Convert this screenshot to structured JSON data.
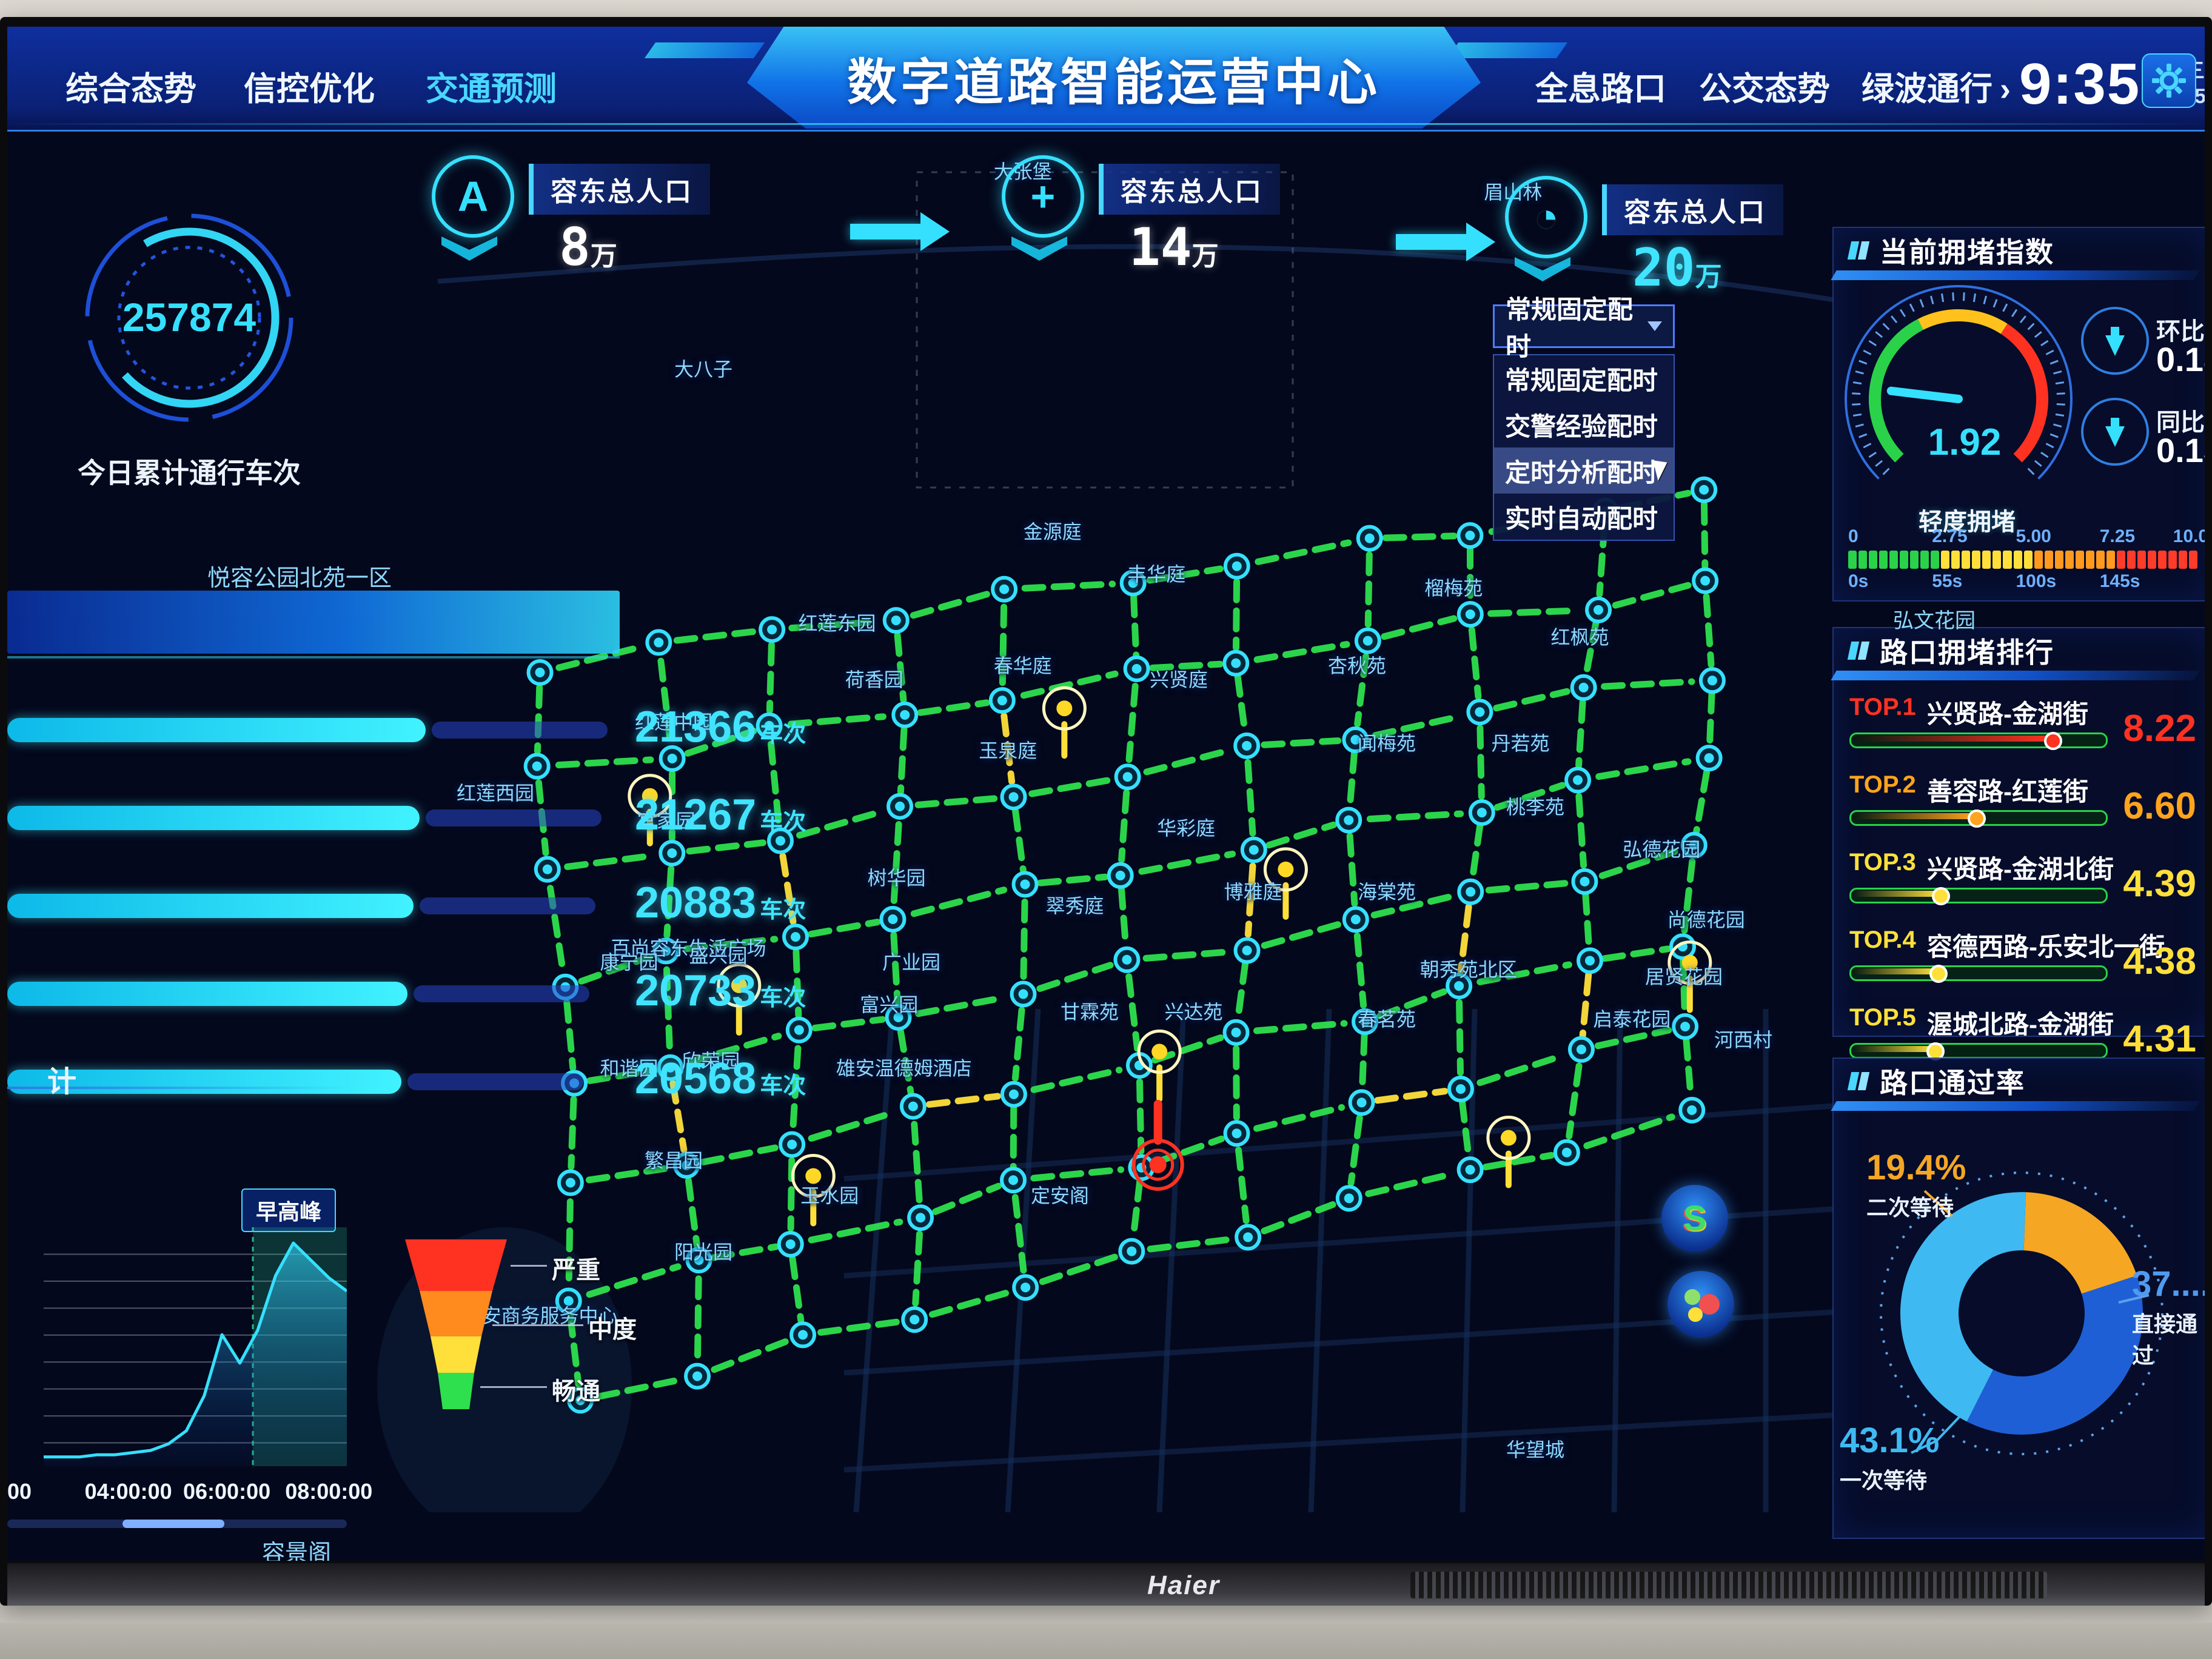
{
  "window": {
    "brand": "Haier"
  },
  "header": {
    "tabs_left": [
      {
        "label": "综合态势",
        "active": false
      },
      {
        "label": "信控优化",
        "active": false
      },
      {
        "label": "交通预测",
        "active": true
      }
    ],
    "title": "数字道路智能运营中心",
    "tabs_right": [
      "全息路口",
      "公交态势",
      "绿波通行"
    ],
    "time": "9:35",
    "weekday": "星期三",
    "date": "2023.5.31"
  },
  "left_panel": {
    "total_gauge": {
      "value": "257874",
      "label": "今日累计通行车次"
    },
    "flow_rank": {
      "region_label": "悦容公园北苑一区",
      "unit": "车次",
      "items": [
        {
          "value": "21366"
        },
        {
          "value": "21267"
        },
        {
          "value": "20883"
        },
        {
          "value": "20733"
        },
        {
          "value": "20568"
        }
      ]
    },
    "flow_trend": {
      "section_title_partial": "计",
      "peak_tag": "早高峰",
      "bottom_label": "容景阁",
      "chart_data": {
        "type": "area",
        "title": "早高峰流量趋势",
        "x_ticks": [
          "00",
          "04:00:00",
          "06:00:00",
          "08:00:00"
        ],
        "x_range": [
          "02:00:00",
          "09:00:00"
        ],
        "values": [
          2,
          2,
          2,
          3,
          3,
          4,
          5,
          8,
          14,
          30,
          58,
          45,
          60,
          85,
          100,
          92,
          84,
          78
        ],
        "highlight_band_pct": [
          69,
          100
        ],
        "grid": true
      }
    }
  },
  "map": {
    "population_badges": [
      {
        "icon": "a-badge-icon",
        "glyph": "A",
        "label": "容东总人口",
        "value": "8",
        "unit": "万",
        "cyan": false
      },
      {
        "icon": "medical-cross-icon",
        "glyph": "+",
        "label": "容东总人口",
        "value": "14",
        "unit": "万",
        "cyan": false
      },
      {
        "icon": "gauge-icon",
        "glyph": "◔",
        "label": "容东总人口",
        "value": "20",
        "unit": "万",
        "cyan": true
      }
    ],
    "timing_dropdown": {
      "selected": "常规固定配时",
      "options": [
        "常规固定配时",
        "交警经验配时",
        "定时分析配时",
        "实时自动配时"
      ],
      "highlighted_option": "定时分析配时"
    },
    "legend": {
      "items": [
        {
          "label": "严重",
          "color": "#ff3222"
        },
        {
          "label": "中度",
          "color": "#ffb300"
        },
        {
          "label": "畅通",
          "color": "#2ee04e"
        }
      ]
    },
    "float_buttons": [
      {
        "name": "s-route-button"
      },
      {
        "name": "status-cluster-button"
      }
    ],
    "labels": [
      [
        "大八子",
        24,
        19
      ],
      [
        "大张堡",
        45.5,
        5
      ],
      [
        "眉山林",
        78.5,
        6.5
      ],
      [
        "金源庭",
        47.5,
        30.5
      ],
      [
        "丰华庭",
        54.5,
        33.5
      ],
      [
        "榴梅苑",
        74.5,
        34.5
      ],
      [
        "红枫苑",
        83,
        38
      ],
      [
        "红莲东园",
        33,
        37
      ],
      [
        "荷香园",
        35.5,
        41
      ],
      [
        "春华庭",
        45.5,
        40
      ],
      [
        "兴贤庭",
        56,
        41
      ],
      [
        "杏秋苑",
        68,
        40
      ],
      [
        "红莲中园",
        22,
        44
      ],
      [
        "玉泉庭",
        44.5,
        46
      ],
      [
        "闻梅苑",
        70,
        45.5
      ],
      [
        "丹若苑",
        79,
        45.5
      ],
      [
        "红莲西园",
        10,
        49
      ],
      [
        "官家园",
        21.5,
        51
      ],
      [
        "华彩庭",
        56.5,
        51.5
      ],
      [
        "桃李苑",
        80,
        50
      ],
      [
        "树华园",
        37,
        55
      ],
      [
        "翠秀庭",
        49,
        57
      ],
      [
        "博雅庭",
        61,
        56
      ],
      [
        "海棠苑",
        70,
        56
      ],
      [
        "朝秀苑北区",
        75.5,
        61.5
      ],
      [
        "百尚容东生活广场",
        23,
        60
      ],
      [
        "甘霖苑",
        50,
        64.5
      ],
      [
        "兴达苑",
        57,
        64.5
      ],
      [
        "春茗苑",
        70,
        65
      ],
      [
        "弘德花园",
        88.5,
        53
      ],
      [
        "富兴园",
        36.5,
        64
      ],
      [
        "广业园",
        38,
        61
      ],
      [
        "康宁园",
        19,
        61
      ],
      [
        "盛兴园",
        25,
        60.5
      ],
      [
        "尚德花园",
        91.5,
        58
      ],
      [
        "和谐园",
        19,
        68.5
      ],
      [
        "欣荣园",
        24.5,
        68
      ],
      [
        "雄安温德姆酒店",
        37.5,
        68.5
      ],
      [
        "居贤花园",
        90,
        62
      ],
      [
        "繁昌园",
        22,
        75
      ],
      [
        "启泰花园",
        86.5,
        65
      ],
      [
        "玉水园",
        32.5,
        77.5
      ],
      [
        "定安阁",
        48,
        77.5
      ],
      [
        "阳光园",
        24,
        81.5
      ],
      [
        "河西村",
        94,
        66.5
      ],
      [
        "华望城",
        80,
        95.5
      ],
      [
        "容安商务服务中心",
        13,
        86
      ]
    ],
    "overlay_labels": [
      {
        "text": "弘文花园",
        "x": 3110,
        "y": 952
      }
    ],
    "network": {
      "cols": 11,
      "rows": 8,
      "quad": {
        "tl": [
          13,
          40
        ],
        "tr": [
          92,
          28
        ],
        "br": [
          90,
          72
        ],
        "bl": [
          16,
          92
        ]
      },
      "road_color": "#2ee04e",
      "yellow_edges": [
        [
          2,
          2,
          "v"
        ],
        [
          4,
          1,
          "v"
        ],
        [
          6,
          3,
          "v"
        ],
        [
          8,
          4,
          "v"
        ],
        [
          3,
          5,
          "h"
        ],
        [
          7,
          6,
          "h"
        ],
        [
          1,
          4,
          "v"
        ],
        [
          9,
          5,
          "v"
        ]
      ],
      "yellow_nodes_pct": [
        [
          20.4,
          49.3
        ],
        [
          26.4,
          62.7
        ],
        [
          48.3,
          43.1
        ],
        [
          63.2,
          54.5
        ],
        [
          31.4,
          76.2
        ],
        [
          90.4,
          61.1
        ],
        [
          78.2,
          73.5
        ],
        [
          54.7,
          67.4
        ]
      ],
      "red_nodes_pct": [
        [
          54.6,
          75.4
        ]
      ]
    }
  },
  "right_panels": {
    "congestion_index": {
      "title": "当前拥堵指数",
      "gauge_value": "1.92",
      "gauge_range": [
        0,
        10
      ],
      "stats": [
        {
          "label": "环比",
          "value": "0.18",
          "trend": "down"
        },
        {
          "label": "同比",
          "value": "0.13",
          "trend": "down"
        }
      ],
      "level_label": "轻度拥堵",
      "scale_top": [
        "0",
        "2.75",
        "5.00",
        "7.25",
        "10.0"
      ],
      "scale_bottom": [
        "0s",
        "55s",
        "100s",
        "145s"
      ]
    },
    "congestion_rank": {
      "title": "路口拥堵排行",
      "chart_data": {
        "type": "bar",
        "categories": [
          "兴贤路-金湖街",
          "善容路-红莲街",
          "兴贤路-金湖北街",
          "容德西路-乐安北一街",
          "渥城北路-金湖街"
        ],
        "values": [
          8.22,
          6.6,
          4.39,
          4.38,
          4.31
        ]
      },
      "items": [
        {
          "rank": "TOP.1",
          "name": "兴贤路-金湖街",
          "value": "8.22",
          "color": "#ff3222",
          "pct": 78
        },
        {
          "rank": "TOP.2",
          "name": "善容路-红莲街",
          "value": "6.60",
          "color": "#ffa41c",
          "pct": 48
        },
        {
          "rank": "TOP.3",
          "name": "兴贤路-金湖北街",
          "value": "4.39",
          "color": "#ffe03a",
          "pct": 34
        },
        {
          "rank": "TOP.4",
          "name": "容德西路-乐安北一街",
          "value": "4.38",
          "color": "#ffe03a",
          "pct": 33
        },
        {
          "rank": "TOP.5",
          "name": "渥城北路-金湖街",
          "value": "4.31",
          "color": "#ffe03a",
          "pct": 32
        }
      ]
    },
    "pass_rate": {
      "title": "路口通过率",
      "chart_data": {
        "type": "pie",
        "slices": [
          {
            "label": "二次等待",
            "value": 19.4,
            "display": "19.4%",
            "color": "#f5a623"
          },
          {
            "label": "直接通过",
            "value": 37.5,
            "display": "37....",
            "color": "#1e5fd6"
          },
          {
            "label": "一次等待",
            "value": 43.1,
            "display": "43.1%",
            "color": "#3fb9f2"
          }
        ],
        "start_angle_deg": -88,
        "legend_position": "around"
      }
    }
  }
}
